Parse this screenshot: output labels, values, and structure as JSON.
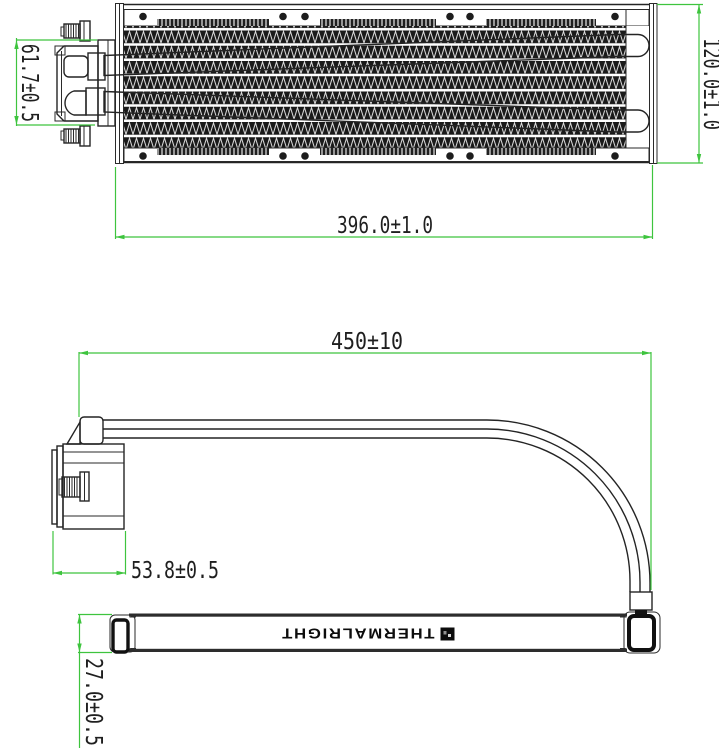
{
  "brand_label": "THERMALRIGHT",
  "views": {
    "top_view": {
      "dims": {
        "pump_height": "61.7±0.5",
        "radiator_width": "120.0±1.0",
        "radiator_length": "396.0±1.0"
      }
    },
    "side_view": {
      "dims": {
        "tube_length": "450±10",
        "pump_length": "53.8±0.5",
        "radiator_thickness": "27.0±0.5"
      }
    }
  },
  "colors": {
    "dimension_line": "#3ec43e",
    "drawing_line": "#242424",
    "background": "#ffffff"
  }
}
